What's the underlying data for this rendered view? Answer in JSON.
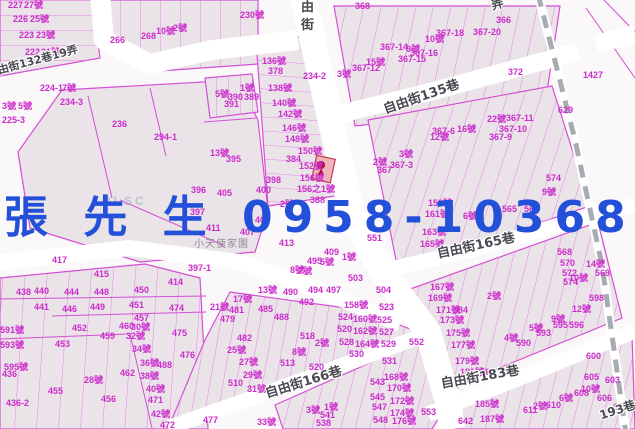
{
  "map": {
    "overlay": {
      "contact": "張 先 生 0958-103680"
    },
    "watermark": "NLSC",
    "place_label": "小天使家園",
    "street_labels": [
      {
        "text": "自由街132巷19弄",
        "x": -14,
        "y": 68,
        "rot": -15,
        "size": 11
      },
      {
        "text": "由",
        "x": 301,
        "y": 1,
        "rot": 0,
        "size": 13
      },
      {
        "text": "街",
        "x": 301,
        "y": 19,
        "rot": 0,
        "size": 13
      },
      {
        "text": "弄",
        "x": 490,
        "y": 0,
        "rot": -15,
        "size": 12
      },
      {
        "text": "自由街135巷",
        "x": 382,
        "y": 104,
        "rot": -19,
        "size": 13
      },
      {
        "text": "自由街165巷",
        "x": 436,
        "y": 248,
        "rot": -12,
        "size": 13
      },
      {
        "text": "自由街166巷",
        "x": 264,
        "y": 388,
        "rot": -17,
        "size": 13
      },
      {
        "text": "自由街183巷",
        "x": 440,
        "y": 378,
        "rot": -10,
        "size": 13
      },
      {
        "text": "193巷",
        "x": 598,
        "y": 410,
        "rot": -18,
        "size": 12
      }
    ],
    "parcel_labels": [
      [
        "227",
        8,
        1
      ],
      [
        "27號",
        24,
        1
      ],
      [
        "226",
        13,
        15
      ],
      [
        "25號",
        30,
        15
      ],
      [
        "223",
        19,
        31
      ],
      [
        "23號",
        36,
        31
      ],
      [
        "222",
        25,
        48
      ],
      [
        "21號",
        41,
        48
      ],
      [
        "266",
        110,
        36
      ],
      [
        "268",
        141,
        32
      ],
      [
        "10號",
        156,
        27
      ],
      [
        "2號",
        173,
        24
      ],
      [
        "224-1",
        40,
        84
      ],
      [
        "7號",
        62,
        84
      ],
      [
        "234-3",
        60,
        98
      ],
      [
        "236",
        112,
        120
      ],
      [
        "294-1",
        154,
        133
      ],
      [
        "3號",
        2,
        102
      ],
      [
        "5號",
        18,
        102
      ],
      [
        "225-3",
        2,
        116
      ],
      [
        "230號",
        240,
        11
      ],
      [
        "368",
        355,
        2
      ],
      [
        "136號",
        262,
        57
      ],
      [
        "378",
        268,
        67
      ],
      [
        "138號",
        268,
        84
      ],
      [
        "140號",
        272,
        99
      ],
      [
        "142號",
        278,
        110
      ],
      [
        "146號",
        282,
        124
      ],
      [
        "148號",
        285,
        135
      ],
      [
        "150號",
        298,
        147
      ],
      [
        "384",
        286,
        155
      ],
      [
        "152號",
        299,
        162
      ],
      [
        "156號",
        300,
        174
      ],
      [
        "156之1號",
        297,
        185
      ],
      [
        "398",
        266,
        176
      ],
      [
        "400",
        256,
        186
      ],
      [
        "390",
        228,
        93
      ],
      [
        "389",
        244,
        93
      ],
      [
        "391",
        224,
        100
      ],
      [
        "1號",
        240,
        84
      ],
      [
        "5號",
        215,
        90
      ],
      [
        "234-2",
        303,
        72
      ],
      [
        "3號",
        337,
        70
      ],
      [
        "367-12",
        352,
        64
      ],
      [
        "15號",
        366,
        58
      ],
      [
        "367-14",
        380,
        43
      ],
      [
        "9號",
        406,
        45
      ],
      [
        "367-16",
        410,
        49
      ],
      [
        "367-15",
        398,
        55
      ],
      [
        "366",
        496,
        16
      ],
      [
        "372",
        508,
        68
      ],
      [
        "367-18",
        436,
        29
      ],
      [
        "367-20",
        473,
        28
      ],
      [
        "10號",
        425,
        35
      ],
      [
        "1427",
        583,
        71
      ],
      [
        "629",
        558,
        106
      ],
      [
        "22號",
        487,
        115
      ],
      [
        "367-11",
        506,
        114
      ],
      [
        "367-10",
        499,
        125
      ],
      [
        "367-6",
        432,
        127
      ],
      [
        "16號",
        457,
        125
      ],
      [
        "367-9",
        489,
        133
      ],
      [
        "12號",
        430,
        133
      ],
      [
        "396",
        191,
        186
      ],
      [
        "405",
        217,
        189
      ],
      [
        "397",
        190,
        208
      ],
      [
        "401",
        255,
        216
      ],
      [
        "407",
        240,
        228
      ],
      [
        "411",
        206,
        224
      ],
      [
        "413",
        279,
        239
      ],
      [
        "395",
        226,
        155
      ],
      [
        "13號",
        210,
        149
      ],
      [
        "417",
        52,
        256
      ],
      [
        "415",
        94,
        270
      ],
      [
        "397-1",
        188,
        264
      ],
      [
        "414",
        168,
        278
      ],
      [
        "388",
        310,
        196
      ],
      [
        "2號",
        280,
        200
      ],
      [
        "367",
        377,
        166
      ],
      [
        "2號",
        373,
        158
      ],
      [
        "367-3",
        390,
        161
      ],
      [
        "3號",
        399,
        150
      ],
      [
        "551",
        367,
        234
      ],
      [
        "552",
        409,
        338
      ],
      [
        "409",
        324,
        248
      ],
      [
        "495",
        307,
        257
      ],
      [
        "5號",
        320,
        258
      ],
      [
        "1號",
        342,
        253
      ],
      [
        "8號",
        290,
        266
      ],
      [
        "7號",
        298,
        267
      ],
      [
        "503",
        348,
        274
      ],
      [
        "9號",
        542,
        188
      ],
      [
        "565",
        502,
        205
      ],
      [
        "563",
        524,
        205
      ],
      [
        "6號",
        463,
        212
      ],
      [
        "574",
        546,
        174
      ],
      [
        "159號",
        428,
        199
      ],
      [
        "161號",
        425,
        210
      ],
      [
        "163號",
        422,
        228
      ],
      [
        "165號",
        420,
        240
      ],
      [
        "167號",
        430,
        283
      ],
      [
        "169號",
        428,
        294
      ],
      [
        "171號",
        436,
        306
      ],
      [
        "584",
        453,
        306
      ],
      [
        "173號",
        440,
        316
      ],
      [
        "175號",
        446,
        329
      ],
      [
        "177號",
        451,
        341
      ],
      [
        "179號",
        455,
        357
      ],
      [
        "181號",
        460,
        368
      ],
      [
        "585",
        457,
        376
      ],
      [
        "587",
        480,
        368
      ],
      [
        "2號",
        487,
        292
      ],
      [
        "598",
        589,
        294
      ],
      [
        "12號",
        572,
        305
      ],
      [
        "9號",
        551,
        315
      ],
      [
        "595",
        553,
        321
      ],
      [
        "596",
        569,
        321
      ],
      [
        "5號",
        529,
        324
      ],
      [
        "593",
        536,
        329
      ],
      [
        "4號",
        504,
        334
      ],
      [
        "590",
        516,
        339
      ],
      [
        "568",
        557,
        248
      ],
      [
        "570",
        560,
        259
      ],
      [
        "572",
        562,
        269
      ],
      [
        "574",
        563,
        278
      ],
      [
        "10號",
        569,
        274
      ],
      [
        "14號",
        586,
        260
      ],
      [
        "569",
        595,
        269
      ],
      [
        "600",
        586,
        352
      ],
      [
        "605",
        584,
        373
      ],
      [
        "603",
        605,
        376
      ],
      [
        "10號",
        581,
        385
      ],
      [
        "608",
        574,
        389
      ],
      [
        "606",
        597,
        394
      ],
      [
        "6號",
        559,
        394
      ],
      [
        "610",
        546,
        401
      ],
      [
        "2號",
        533,
        402
      ],
      [
        "611",
        523,
        406
      ],
      [
        "604",
        613,
        403
      ],
      [
        "185號",
        475,
        400
      ],
      [
        "187號",
        480,
        415
      ],
      [
        "642",
        458,
        417
      ],
      [
        "553",
        421,
        408
      ],
      [
        "438",
        16,
        288
      ],
      [
        "440",
        34,
        287
      ],
      [
        "444",
        64,
        288
      ],
      [
        "448",
        94,
        288
      ],
      [
        "450",
        134,
        286
      ],
      [
        "441",
        34,
        303
      ],
      [
        "446",
        62,
        305
      ],
      [
        "449",
        90,
        303
      ],
      [
        "451",
        129,
        301
      ],
      [
        "474",
        169,
        304
      ],
      [
        "457",
        134,
        314
      ],
      [
        "460",
        119,
        322
      ],
      [
        "30號",
        131,
        323
      ],
      [
        "459",
        100,
        332
      ],
      [
        "32號",
        126,
        332
      ],
      [
        "452",
        72,
        324
      ],
      [
        "453",
        55,
        340
      ],
      [
        "475",
        172,
        329
      ],
      [
        "34號",
        132,
        345
      ],
      [
        "476",
        180,
        351
      ],
      [
        "36號",
        140,
        359
      ],
      [
        "488",
        157,
        361
      ],
      [
        "591號",
        0,
        326
      ],
      [
        "593號",
        0,
        341
      ],
      [
        "595號",
        4,
        363
      ],
      [
        "436",
        2,
        370
      ],
      [
        "28號",
        84,
        376
      ],
      [
        "462",
        120,
        369
      ],
      [
        "38號",
        140,
        372
      ],
      [
        "455",
        48,
        387
      ],
      [
        "456",
        101,
        395
      ],
      [
        "40號",
        146,
        385
      ],
      [
        "471",
        148,
        396
      ],
      [
        "436-2",
        6,
        399
      ],
      [
        "42號",
        151,
        410
      ],
      [
        "472",
        160,
        421
      ],
      [
        "477",
        203,
        416
      ],
      [
        "13號",
        258,
        286
      ],
      [
        "490",
        283,
        288
      ],
      [
        "494",
        308,
        286
      ],
      [
        "497",
        326,
        286
      ],
      [
        "17號",
        233,
        295
      ],
      [
        "21號",
        210,
        303
      ],
      [
        "481",
        229,
        306
      ],
      [
        "479",
        220,
        315
      ],
      [
        "485",
        258,
        305
      ],
      [
        "488",
        274,
        313
      ],
      [
        "492",
        299,
        298
      ],
      [
        "504",
        376,
        286
      ],
      [
        "158號",
        344,
        301
      ],
      [
        "523",
        379,
        303
      ],
      [
        "524",
        338,
        313
      ],
      [
        "160號",
        353,
        315
      ],
      [
        "525",
        377,
        316
      ],
      [
        "520",
        337,
        325
      ],
      [
        "162號",
        353,
        327
      ],
      [
        "527",
        379,
        328
      ],
      [
        "528",
        339,
        338
      ],
      [
        "164號",
        355,
        340
      ],
      [
        "529",
        381,
        340
      ],
      [
        "530",
        349,
        350
      ],
      [
        "531",
        382,
        357
      ],
      [
        "518",
        300,
        332
      ],
      [
        "2號",
        315,
        339
      ],
      [
        "482",
        237,
        334
      ],
      [
        "25號",
        227,
        346
      ],
      [
        "27號",
        239,
        358
      ],
      [
        "513",
        280,
        359
      ],
      [
        "8號",
        292,
        348
      ],
      [
        "520",
        309,
        363
      ],
      [
        "29號",
        243,
        371
      ],
      [
        "510",
        228,
        379
      ],
      [
        "31號",
        247,
        385
      ],
      [
        "543",
        370,
        378
      ],
      [
        "168號",
        384,
        373
      ],
      [
        "170號",
        387,
        384
      ],
      [
        "545",
        370,
        393
      ],
      [
        "172號",
        390,
        397
      ],
      [
        "547",
        372,
        403
      ],
      [
        "174號",
        390,
        409
      ],
      [
        "548",
        373,
        416
      ],
      [
        "176號",
        392,
        417
      ],
      [
        "1號",
        324,
        403
      ],
      [
        "3號",
        306,
        406
      ],
      [
        "541",
        320,
        411
      ],
      [
        "538",
        316,
        419
      ],
      [
        "33號",
        257,
        418
      ]
    ]
  },
  "colors": {
    "bg": "#fbf8fa",
    "blockfill": "#eae4e9",
    "line": "#d44fd4",
    "stripe": "#e583e5",
    "label": "#cb2ccb",
    "streettext": "#4a4a52",
    "road": "#ffffff",
    "railway": "#a7abb2",
    "blue": "#2350d8",
    "hlfill": "#efb3bb",
    "hlborder": "#c23b50"
  }
}
